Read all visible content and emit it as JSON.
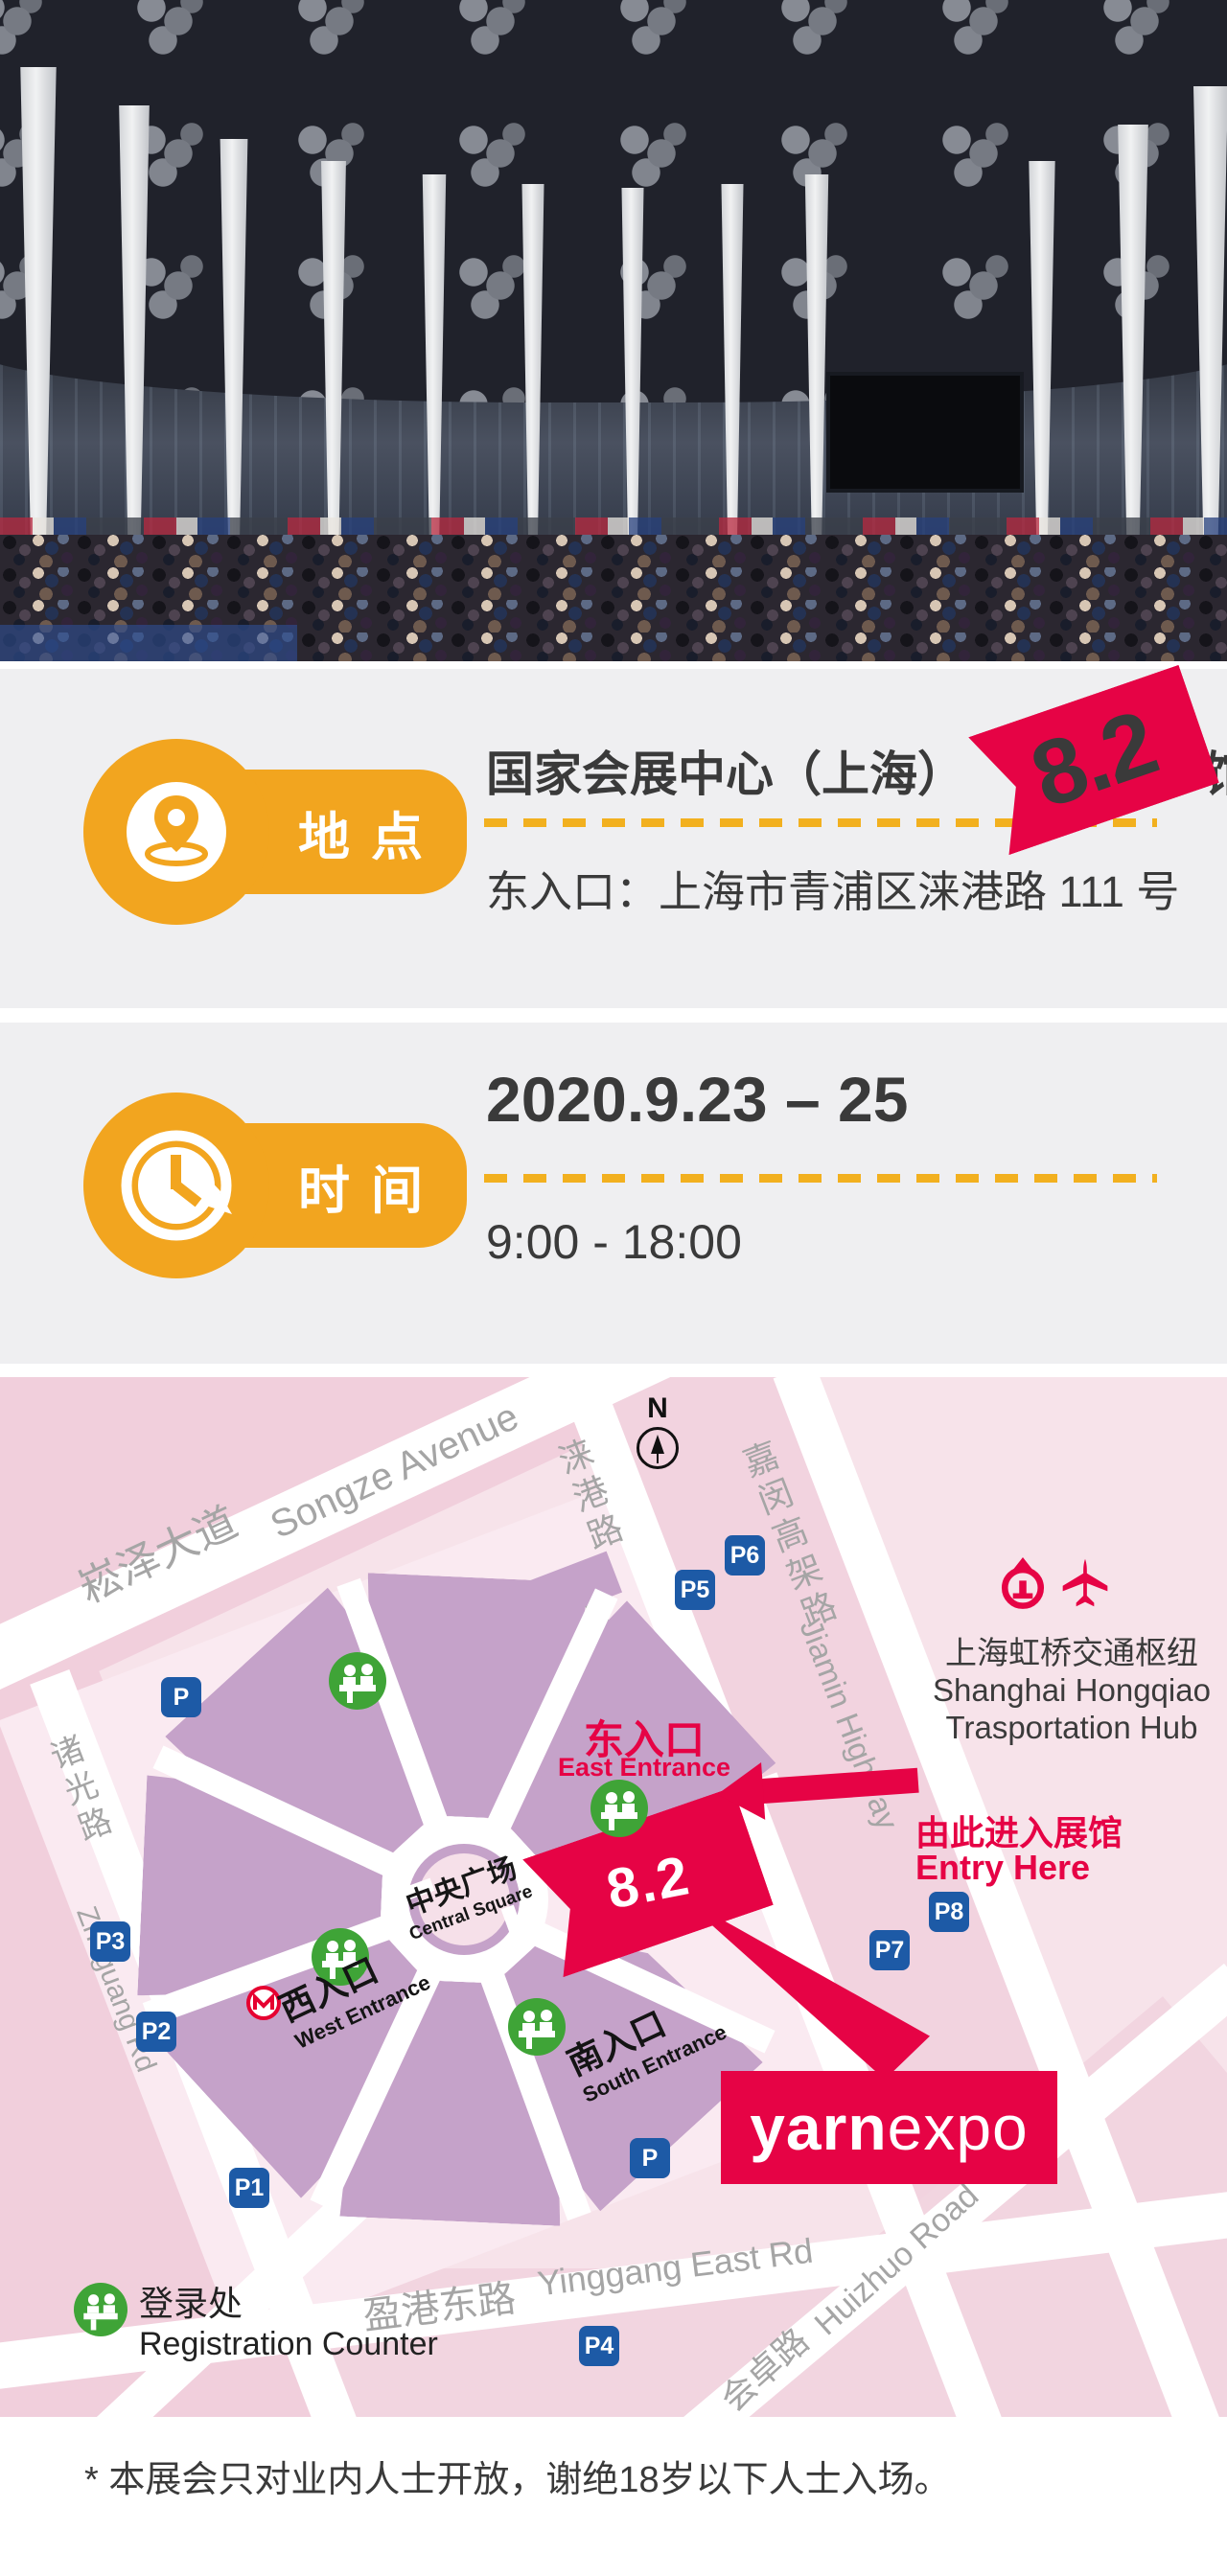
{
  "location": {
    "tab": "地点",
    "venue": "国家会展中心（上海）",
    "hall": "8.2",
    "hall_unit": "馆",
    "address": "东入口：上海市青浦区涞港路 111 号"
  },
  "time": {
    "tab": "时间",
    "dates": "2020.9.23 – 25",
    "hours": "9:00 - 18:00"
  },
  "map": {
    "north_label": "N",
    "roads": {
      "songze": {
        "zh": "崧泽大道",
        "en": "Songze Avenue"
      },
      "laigang": {
        "zh": "涞港路",
        "en": "Laigang Rd"
      },
      "jiamin": {
        "zh": "嘉闵高架路",
        "en": "Jiamin Highway"
      },
      "zhuguang": {
        "zh": "诸光路",
        "en": "Zhuguang Rd"
      },
      "yinggang": {
        "zh": "盈港东路",
        "en": "Yinggang East Rd"
      },
      "huizhuo": {
        "zh": "会卓路",
        "en": "Huizhuo Road"
      }
    },
    "central_square": {
      "zh": "中央广场",
      "en": "Central Square"
    },
    "hall_label": "8.2",
    "east": {
      "zh": "东入口",
      "en": "East Entrance"
    },
    "west": {
      "zh": "西入口",
      "en": "West Entrance"
    },
    "south": {
      "zh": "南入口",
      "en": "South Entrance"
    },
    "entry": {
      "zh": "由此进入展馆",
      "en": "Entry Here"
    },
    "hub": {
      "zh": "上海虹桥交通枢纽",
      "en_line1": "Shanghai Hongqiao",
      "en_line2": "Trasportation Hub"
    },
    "legend": {
      "zh": "登录处",
      "en": "Registration Counter"
    },
    "brand": {
      "bold_part": "yarn",
      "regular_part": "expo"
    },
    "parking": {
      "p": "P",
      "p1": "P1",
      "p2": "P2",
      "p3": "P3",
      "p4": "P4",
      "p5": "P5",
      "p6": "P6",
      "p7": "P7",
      "p8": "P8",
      "p_south": "P"
    }
  },
  "footer": {
    "note": "* 本展会只对业内人士开放，谢绝18岁以下人士入场。"
  },
  "colors": {
    "accent_yellow": "#F2A51F",
    "accent_red": "#E60345",
    "parking_blue": "#1D5AA6",
    "entrance_green": "#3FA437",
    "venue_purple": "#C5A2C9",
    "map_pink": "#F7E3EA"
  }
}
